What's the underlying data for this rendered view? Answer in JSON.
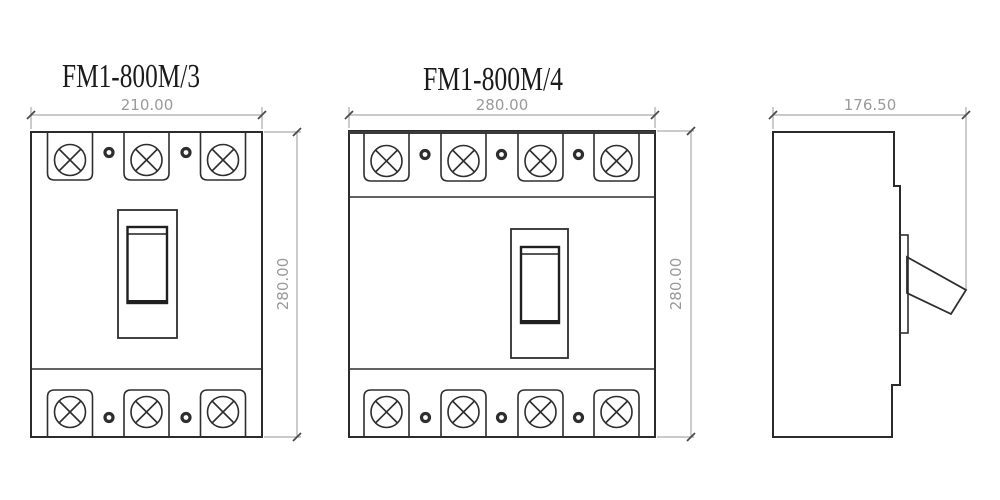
{
  "drawing": {
    "background": "#ffffff",
    "line_color": "#2b2b2b",
    "dim_line_color": "#aaaaaa",
    "dim_text_color": "#9a9a9a",
    "views": {
      "front_3p": {
        "title": "FM1-800M/3",
        "poles": 3,
        "width_label": "210.00",
        "height_label": "280.00"
      },
      "front_4p": {
        "title": "FM1-800M/4",
        "poles": 4,
        "width_label": "280.00",
        "height_label": "280.00"
      },
      "side": {
        "depth_label": "176.50"
      }
    }
  }
}
